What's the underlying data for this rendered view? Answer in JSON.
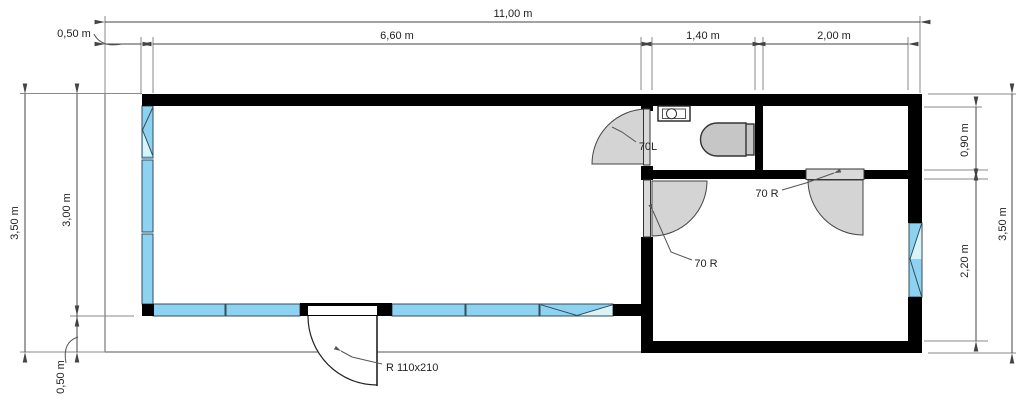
{
  "title": "floor-plan",
  "colors": {
    "wall": "#000000",
    "window_blue": "#8ed2f2",
    "window_pale": "#d8f4f8",
    "door_fill": "#d4d4d4",
    "line": "#444444",
    "text": "#222222"
  },
  "dimensions": {
    "top": {
      "total": "11,00 m",
      "offset": "0,50 m",
      "living": "6,60 m",
      "bath": "1,40 m",
      "storage": "2,00 m"
    },
    "left": {
      "total": "3,50 m",
      "building": "3,00 m",
      "terrace": "0,50 m"
    },
    "right": {
      "storage": "0,90 m",
      "room": "2,20 m",
      "total": "3,50 m"
    }
  },
  "doors": {
    "bath": "70L",
    "room_side": "70 R",
    "room_top": "70 R",
    "entry": "R 110x210"
  }
}
